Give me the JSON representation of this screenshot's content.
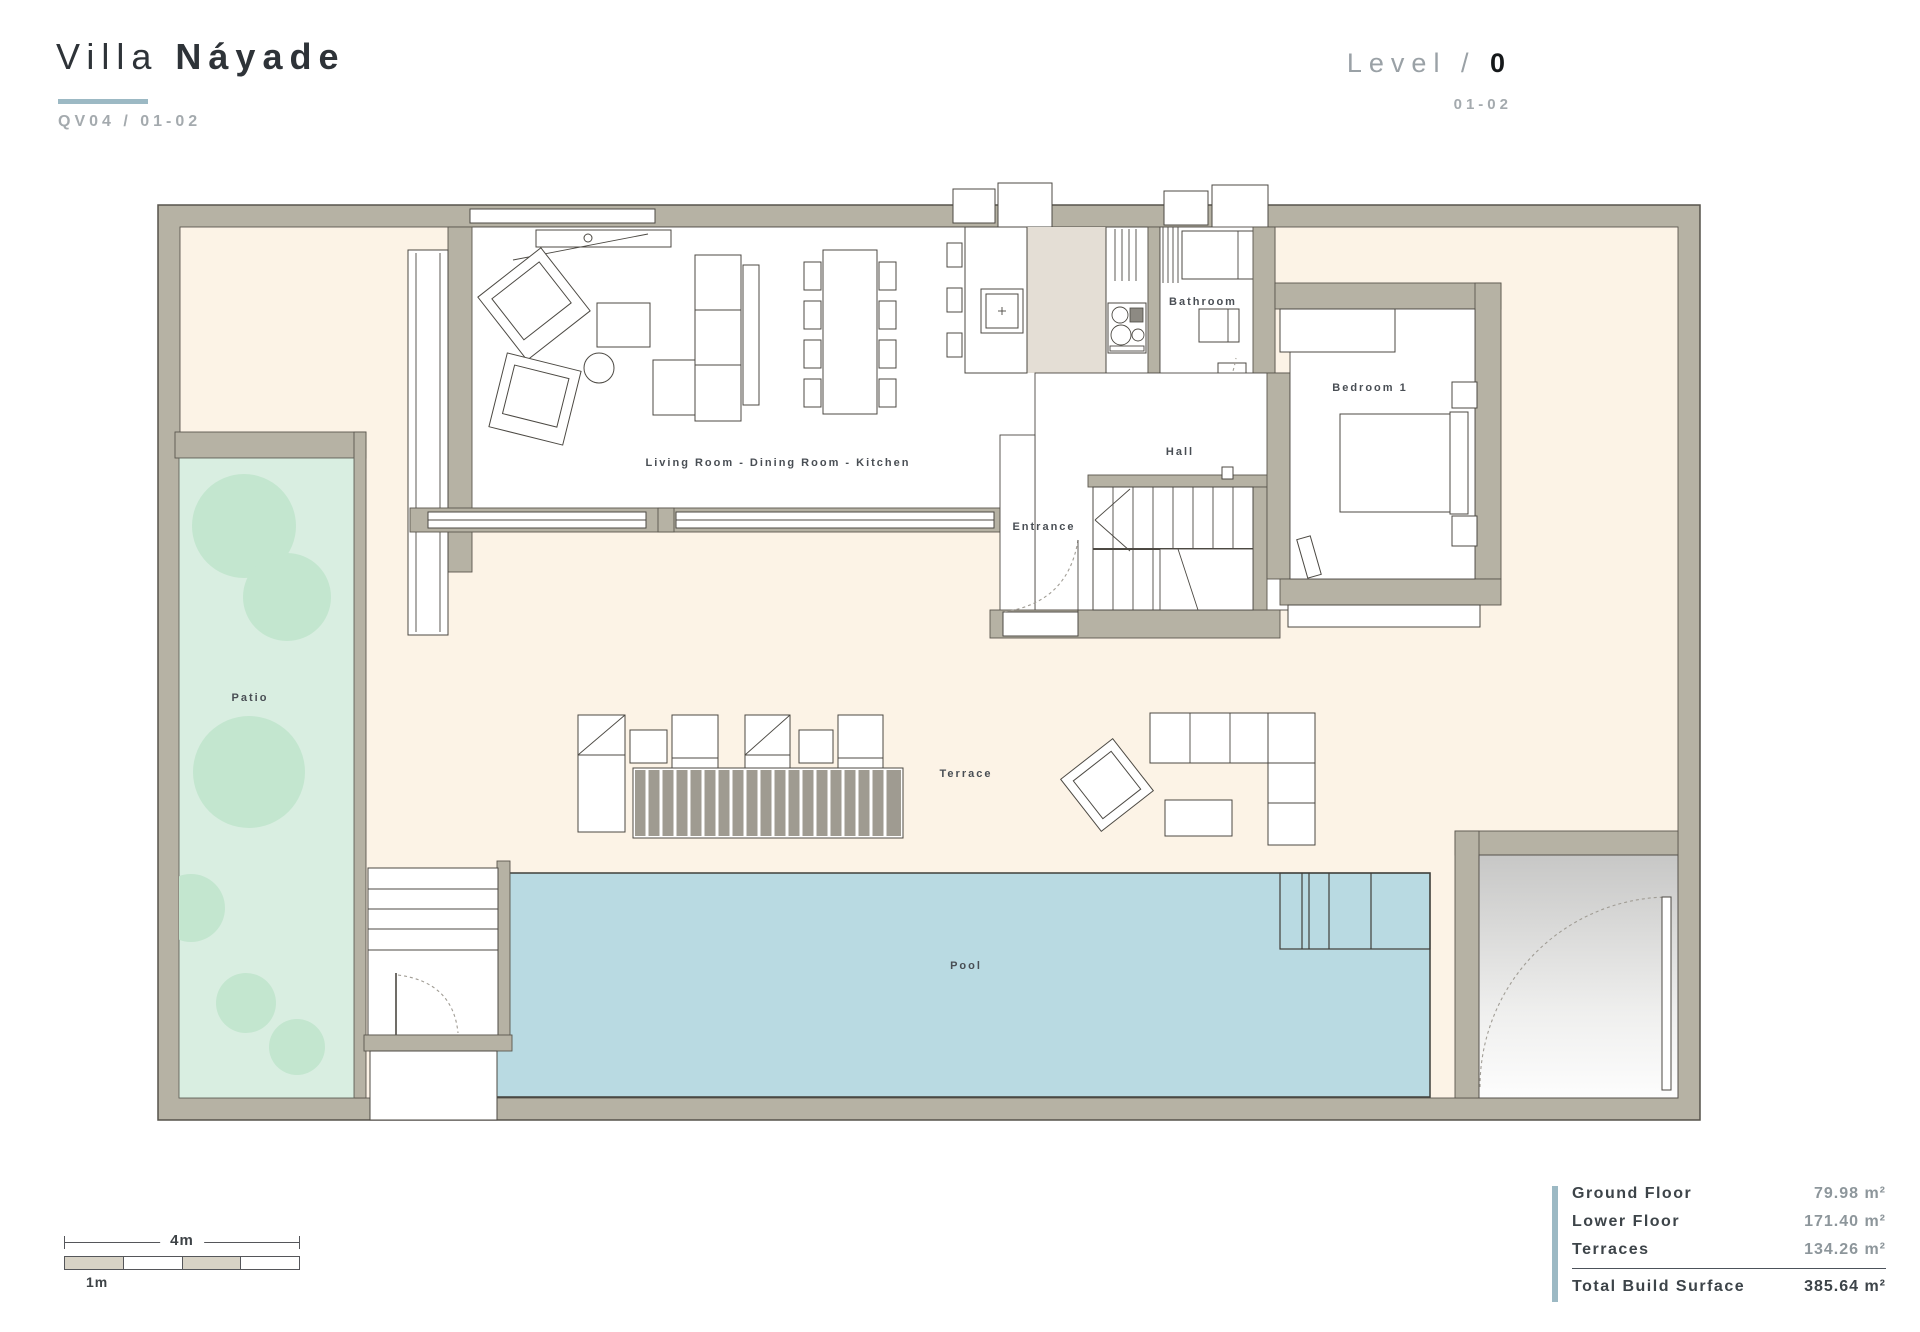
{
  "header": {
    "title_light": "Villa",
    "title_bold": "Náyade",
    "subtitle": "QV04 / 01-02",
    "level_label": "Level /",
    "level_value": "0",
    "level_sub": "01-02"
  },
  "plan": {
    "room_labels": {
      "living": "Living Room - Dining Room - Kitchen",
      "bathroom": "Bathroom",
      "bedroom1": "Bedroom 1",
      "hall": "Hall",
      "entrance": "Entrance",
      "patio": "Patio",
      "terrace": "Terrace",
      "pool": "Pool"
    }
  },
  "areas_table": {
    "rows": [
      {
        "label": "Ground Floor",
        "value": "79.98 m²"
      },
      {
        "label": "Lower Floor",
        "value": "171.40 m²"
      },
      {
        "label": "Terraces",
        "value": "134.26 m²"
      }
    ],
    "total": {
      "label": "Total Build Surface",
      "value": "385.64 m²"
    }
  },
  "scale_bar": {
    "top_label": "4m",
    "bottom_label": "1m"
  },
  "colors": {
    "accent": "#9cb9c4",
    "wall": "#b6b2a4",
    "plot_interior": "#fcf3e6",
    "patio_green": "#d9eee1",
    "tree_green": "#c3e6cf",
    "pool_blue": "#b9dae2",
    "kitchen_floor": "#e4ded5",
    "title_text": "#2e3338",
    "muted_text": "#a4aaae"
  }
}
